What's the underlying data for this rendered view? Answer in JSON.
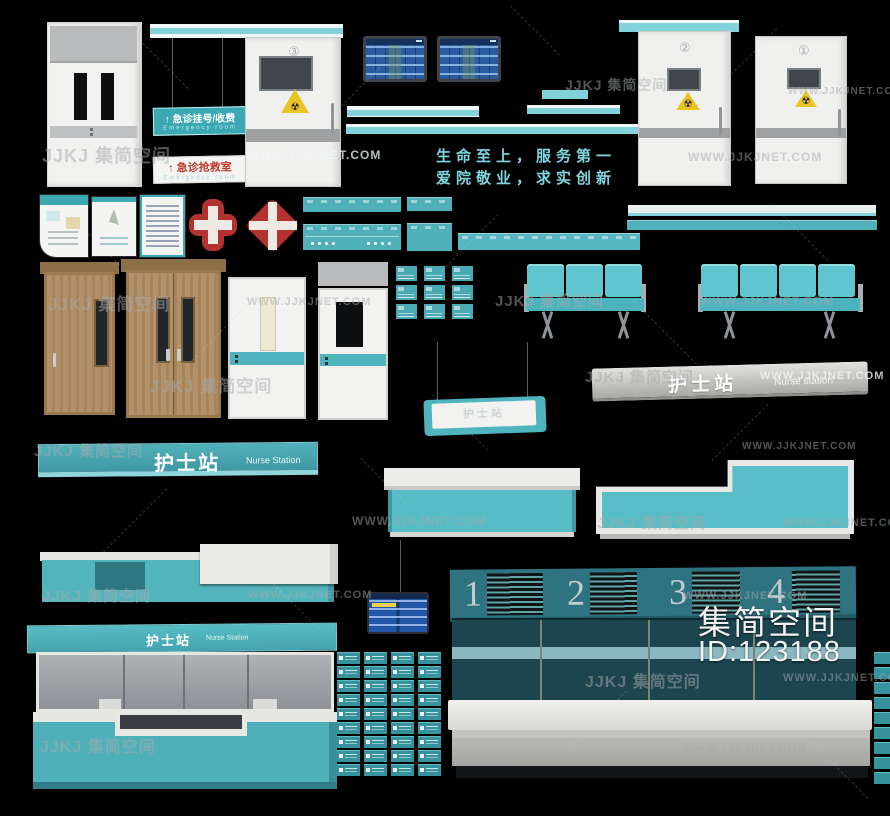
{
  "page": {
    "width": 890,
    "height": 816,
    "background": "#000000"
  },
  "brand_overlay": {
    "name": "集简空间",
    "id": "ID:123188"
  },
  "watermarks": {
    "logo_text": "JJKJ 集简空间",
    "url_text": "WWW.JJKJNET.COM",
    "instances": [
      {
        "type": "logo",
        "x": 42,
        "y": 142,
        "size": 18,
        "tone": "gray"
      },
      {
        "type": "url",
        "x": 247,
        "y": 148,
        "size": 12,
        "tone": "light"
      },
      {
        "type": "url",
        "x": 688,
        "y": 150,
        "size": 12,
        "tone": "gray"
      },
      {
        "type": "url",
        "x": 788,
        "y": 86,
        "size": 10,
        "tone": "gray"
      },
      {
        "type": "logo",
        "x": 565,
        "y": 75,
        "size": 14,
        "tone": "gray"
      },
      {
        "type": "logo",
        "x": 48,
        "y": 290,
        "size": 17,
        "tone": "gray"
      },
      {
        "type": "url",
        "x": 247,
        "y": 296,
        "size": 11,
        "tone": "gray"
      },
      {
        "type": "logo",
        "x": 150,
        "y": 372,
        "size": 17,
        "tone": "gray"
      },
      {
        "type": "logo",
        "x": 495,
        "y": 290,
        "size": 15,
        "tone": "gray"
      },
      {
        "type": "url",
        "x": 700,
        "y": 294,
        "size": 12,
        "tone": "gray"
      },
      {
        "type": "logo",
        "x": 585,
        "y": 366,
        "size": 15,
        "tone": "gray"
      },
      {
        "type": "url",
        "x": 760,
        "y": 370,
        "size": 11,
        "tone": "light"
      },
      {
        "type": "logo",
        "x": 34,
        "y": 440,
        "size": 15,
        "tone": "gray"
      },
      {
        "type": "url",
        "x": 742,
        "y": 441,
        "size": 10,
        "tone": "gray"
      },
      {
        "type": "url",
        "x": 352,
        "y": 514,
        "size": 12,
        "tone": "gray"
      },
      {
        "type": "logo",
        "x": 597,
        "y": 512,
        "size": 15,
        "tone": "gray"
      },
      {
        "type": "url",
        "x": 783,
        "y": 517,
        "size": 11,
        "tone": "gray"
      },
      {
        "type": "logo",
        "x": 42,
        "y": 585,
        "size": 15,
        "tone": "gray"
      },
      {
        "type": "url",
        "x": 248,
        "y": 589,
        "size": 11,
        "tone": "gray"
      },
      {
        "type": "url",
        "x": 683,
        "y": 590,
        "size": 11,
        "tone": "gray"
      },
      {
        "type": "logo",
        "x": 585,
        "y": 668,
        "size": 16,
        "tone": "gray"
      },
      {
        "type": "url",
        "x": 783,
        "y": 672,
        "size": 11,
        "tone": "gray"
      },
      {
        "type": "logo",
        "x": 40,
        "y": 733,
        "size": 16,
        "tone": "gray"
      },
      {
        "type": "url",
        "x": 683,
        "y": 742,
        "size": 11,
        "tone": "gray"
      }
    ]
  },
  "slogan": {
    "line1": "生命至上，服务第一",
    "line2": "爱院敬业，求实创新",
    "color": "#7fd6de"
  },
  "signs": {
    "registration": {
      "arrow": "↑",
      "zh": "急诊挂号/收费",
      "en": "Emergency room"
    },
    "rescue": {
      "arrow": "↑",
      "zh": "急诊抢救室",
      "en": "Emergency room"
    },
    "nurse_teal": {
      "zh": "护士站",
      "en": "Nurse Station"
    },
    "nurse_silver": {
      "zh": "护士站",
      "en": "Nurse station"
    },
    "nurse_hanging": {
      "zh": "护士站"
    },
    "booth_header": {
      "zh": "护士站",
      "en": "Nurse Station"
    }
  },
  "doors": {
    "numbers": {
      "d1": "①",
      "d2": "②",
      "d3": "③"
    },
    "radiation_symbol": "☢"
  },
  "directory_board": {
    "numbers": [
      "1",
      "2",
      "3",
      "4"
    ]
  },
  "grids": {
    "room_cards": {
      "rows": 3,
      "cols": 3
    },
    "door_plates": {
      "rows": 9,
      "cols": 4
    },
    "edge_plates": {
      "count": 9
    }
  },
  "colors": {
    "teal": "#56b9c2",
    "teal_strip": "#82d2da",
    "teal_sign": "#4fb0ba",
    "panel_teal": "#2f7380",
    "wall_teal": "#1c454f",
    "red": "#b23230",
    "warning_yellow": "#e8c525",
    "wood": "#b2906a",
    "screen_blue": "#2c5ca0"
  },
  "deco_dashes": [
    [
      120,
      60,
      80,
      45
    ],
    [
      320,
      92,
      70,
      -45
    ],
    [
      500,
      30,
      70,
      45
    ],
    [
      700,
      60,
      90,
      -45
    ],
    [
      60,
      240,
      70,
      45
    ],
    [
      430,
      242,
      80,
      -45
    ],
    [
      760,
      232,
      80,
      45
    ],
    [
      180,
      332,
      80,
      -45
    ],
    [
      620,
      332,
      90,
      45
    ],
    [
      90,
      520,
      90,
      -45
    ],
    [
      420,
      422,
      80,
      45
    ],
    [
      700,
      432,
      80,
      -45
    ],
    [
      250,
      600,
      80,
      45
    ],
    [
      550,
      722,
      90,
      -45
    ],
    [
      800,
      770,
      80,
      45
    ],
    [
      350,
      482,
      70,
      45
    ]
  ]
}
